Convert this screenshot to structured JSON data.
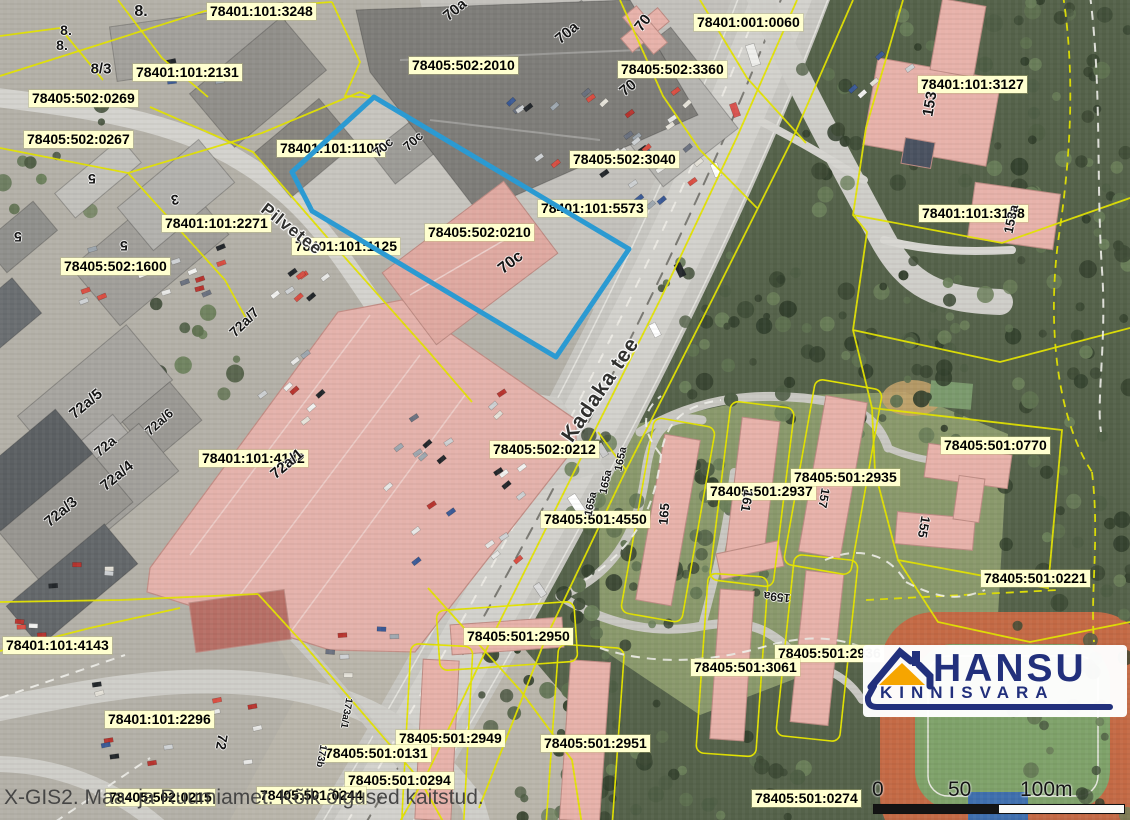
{
  "attribution": "X-GIS2. Maa- ja Ruumiamet. Kõik õigused kaitstud.",
  "scale_bar": {
    "t0": "0",
    "t50": "50",
    "t100": "100m"
  },
  "logo": {
    "title": "HANSU",
    "subtitle": "KINNISVARA",
    "text_color": "#22307c",
    "roof_color": "#f6a500"
  },
  "highlight": {
    "parcel": "78405:502:0210",
    "color": "#2b9ad2"
  },
  "colors": {
    "parcel_line": "#e3e300",
    "label_bg": "#ffffcf"
  },
  "streets": [
    {
      "t": "Pilvetee",
      "x": 263,
      "y": 197,
      "r": 38,
      "s": 17
    },
    {
      "t": "Kadaka tee",
      "x": 567,
      "y": 428,
      "r": -56,
      "s": 21
    }
  ],
  "parcel_labels": [
    {
      "t": "78401:101:3248",
      "x": 207,
      "y": 3
    },
    {
      "t": "78401:001:0060",
      "x": 694,
      "y": 14
    },
    {
      "t": "78405:502:2010",
      "x": 409,
      "y": 57
    },
    {
      "t": "78405:502:3360",
      "x": 618,
      "y": 61
    },
    {
      "t": "78401:101:3127",
      "x": 918,
      "y": 76
    },
    {
      "t": "78401:101:2131",
      "x": 133,
      "y": 64
    },
    {
      "t": "78405:502:0269",
      "x": 29,
      "y": 90
    },
    {
      "t": "78405:502:0267",
      "x": 24,
      "y": 131
    },
    {
      "t": "78405:502:3040",
      "x": 570,
      "y": 151
    },
    {
      "t": "78401:101:1105",
      "x": 277,
      "y": 140
    },
    {
      "t": "78401:101:5573",
      "x": 538,
      "y": 200
    },
    {
      "t": "78401:101:2271",
      "x": 162,
      "y": 215
    },
    {
      "t": "78405:502:0210",
      "x": 425,
      "y": 224
    },
    {
      "t": "78401:101:3128",
      "x": 919,
      "y": 205
    },
    {
      "t": "78405:502:1600",
      "x": 61,
      "y": 258
    },
    {
      "t": "78401:101:1125",
      "x": 292,
      "y": 238
    },
    {
      "t": "78405:502:0212",
      "x": 490,
      "y": 441
    },
    {
      "t": "78405:501:0770",
      "x": 941,
      "y": 437
    },
    {
      "t": "78405:501:2937",
      "x": 707,
      "y": 483
    },
    {
      "t": "78405:501:2935",
      "x": 791,
      "y": 469
    },
    {
      "t": "78405:501:4550",
      "x": 541,
      "y": 511
    },
    {
      "t": "78401:101:4142",
      "x": 199,
      "y": 450
    },
    {
      "t": "78405:501:0221",
      "x": 981,
      "y": 570
    },
    {
      "t": "78405:501:2950",
      "x": 464,
      "y": 628
    },
    {
      "t": "78405:501:2936",
      "x": 775,
      "y": 645
    },
    {
      "t": "78401:101:4143",
      "x": 3,
      "y": 637
    },
    {
      "t": "78405:501:3061",
      "x": 691,
      "y": 659
    },
    {
      "t": "78401:101:2296",
      "x": 105,
      "y": 711
    },
    {
      "t": "78405:501:2949",
      "x": 396,
      "y": 730
    },
    {
      "t": "78405:501:2951",
      "x": 541,
      "y": 735
    },
    {
      "t": "78405:501:0131",
      "x": 322,
      "y": 745
    },
    {
      "t": "78405:501:0294",
      "x": 345,
      "y": 772
    },
    {
      "t": "78405:501:0244",
      "x": 257,
      "y": 787
    },
    {
      "t": "78405:502:0215",
      "x": 106,
      "y": 789
    },
    {
      "t": "78405:501:0274",
      "x": 752,
      "y": 790
    }
  ],
  "building_labels": [
    {
      "t": "8.",
      "x": 141,
      "y": 12,
      "r": 0,
      "s": 16
    },
    {
      "t": "8.",
      "x": 66,
      "y": 30,
      "r": 0,
      "s": 14
    },
    {
      "t": "8.",
      "x": 62,
      "y": 45,
      "r": 0,
      "s": 14
    },
    {
      "t": "8/3",
      "x": 101,
      "y": 69,
      "r": 0,
      "s": 15
    },
    {
      "t": "70a",
      "x": 455,
      "y": 10,
      "r": -40,
      "s": 15
    },
    {
      "t": "70a",
      "x": 567,
      "y": 33,
      "r": -40,
      "s": 15
    },
    {
      "t": "70",
      "x": 643,
      "y": 23,
      "r": -52,
      "s": 15
    },
    {
      "t": "70",
      "x": 628,
      "y": 88,
      "r": -40,
      "s": 15
    },
    {
      "t": "70c",
      "x": 383,
      "y": 147,
      "r": -42,
      "s": 13
    },
    {
      "t": "70c",
      "x": 413,
      "y": 141,
      "r": -42,
      "s": 13
    },
    {
      "t": "70c",
      "x": 511,
      "y": 263,
      "r": -38,
      "s": 16
    },
    {
      "t": "153",
      "x": 930,
      "y": 104,
      "r": -80,
      "s": 15
    },
    {
      "t": "153a",
      "x": 1011,
      "y": 219,
      "r": -78,
      "s": 13
    },
    {
      "t": "5",
      "x": 92,
      "y": 179,
      "r": 180,
      "s": 14
    },
    {
      "t": "5",
      "x": 18,
      "y": 237,
      "r": 180,
      "s": 14
    },
    {
      "t": "5",
      "x": 124,
      "y": 246,
      "r": 180,
      "s": 14
    },
    {
      "t": "3",
      "x": 175,
      "y": 200,
      "r": 170,
      "s": 14
    },
    {
      "t": "72a/7",
      "x": 244,
      "y": 322,
      "r": -45,
      "s": 14
    },
    {
      "t": "72a/5",
      "x": 86,
      "y": 404,
      "r": -40,
      "s": 15
    },
    {
      "t": "72a/6",
      "x": 159,
      "y": 422,
      "r": -42,
      "s": 13
    },
    {
      "t": "72a",
      "x": 105,
      "y": 446,
      "r": -40,
      "s": 14
    },
    {
      "t": "72a/4",
      "x": 117,
      "y": 476,
      "r": -40,
      "s": 15
    },
    {
      "t": "72a/3",
      "x": 61,
      "y": 512,
      "r": -40,
      "s": 15
    },
    {
      "t": "72a/1",
      "x": 287,
      "y": 464,
      "r": -40,
      "s": 15
    },
    {
      "t": "165",
      "x": 664,
      "y": 514,
      "r": -85,
      "s": 13
    },
    {
      "t": "165a",
      "x": 621,
      "y": 459,
      "r": -78,
      "s": 11
    },
    {
      "t": "165a",
      "x": 606,
      "y": 482,
      "r": -78,
      "s": 11
    },
    {
      "t": "165a",
      "x": 591,
      "y": 504,
      "r": -78,
      "s": 11
    },
    {
      "t": "161",
      "x": 747,
      "y": 501,
      "r": 100,
      "s": 13
    },
    {
      "t": "157",
      "x": 824,
      "y": 498,
      "r": 100,
      "s": 12
    },
    {
      "t": "155",
      "x": 924,
      "y": 527,
      "r": 100,
      "s": 13
    },
    {
      "t": "159a",
      "x": 777,
      "y": 597,
      "r": 186,
      "s": 12
    },
    {
      "t": "72",
      "x": 222,
      "y": 742,
      "r": 100,
      "s": 14
    },
    {
      "t": "173a/1",
      "x": 346,
      "y": 713,
      "r": 100,
      "s": 10
    },
    {
      "t": "173b",
      "x": 321,
      "y": 756,
      "r": 100,
      "s": 10
    }
  ]
}
